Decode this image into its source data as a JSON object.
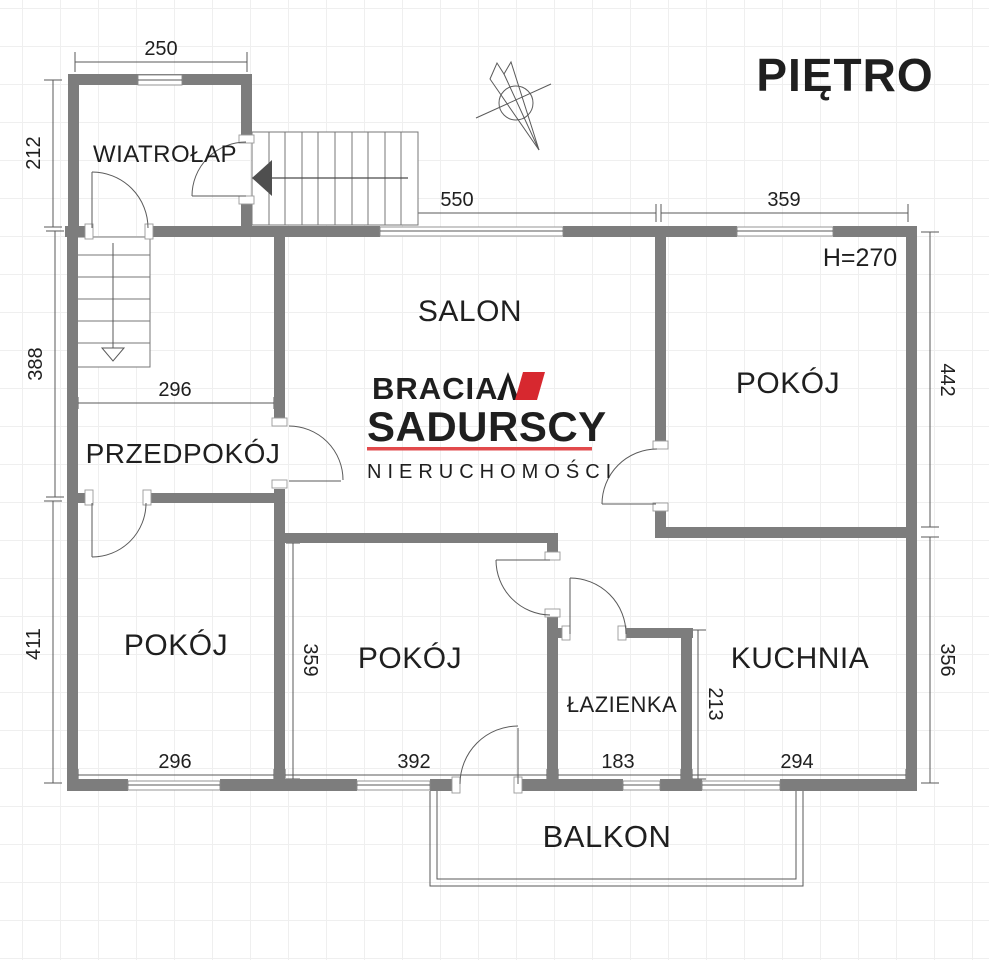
{
  "title": "PIĘTRO",
  "plan": {
    "ceiling_height": "H=270",
    "rooms": {
      "wiatrolap": "WIATROŁAP",
      "salon": "SALON",
      "przedpokoj": "PRZEDPOKÓJ",
      "pokoj_left": "POKÓJ",
      "pokoj_middle": "POKÓJ",
      "pokoj_right": "POKÓJ",
      "kuchnia": "KUCHNIA",
      "lazienka": "ŁAZIENKA",
      "balkon": "BALKON"
    },
    "dimensions": {
      "wiatrolap_width": "250",
      "wiatrolap_height": "212",
      "przedpokoj_height": "388",
      "przedpokoj_width": "296",
      "pokoj_left_height": "411",
      "pokoj_left_width": "296",
      "salon_width": "550",
      "pokoj_right_width_top": "359",
      "pokoj_right_height": "442",
      "kuchnia_height": "356",
      "pokoj_middle_height": "359",
      "pokoj_middle_width": "392",
      "lazienka_width": "183",
      "lazienka_kuchnia_wall": "213",
      "kuchnia_width": "294"
    }
  },
  "logo": {
    "line1": "BRACIA",
    "line2": "SADURSCY",
    "line3": "NIERUCHOMOŚCI"
  },
  "colors": {
    "wall": "#7d7d7d",
    "line": "#5a5a5a",
    "text": "#1f1f1f",
    "logo_red": "#d7282f",
    "logo_red_line": "#e24a4c"
  }
}
